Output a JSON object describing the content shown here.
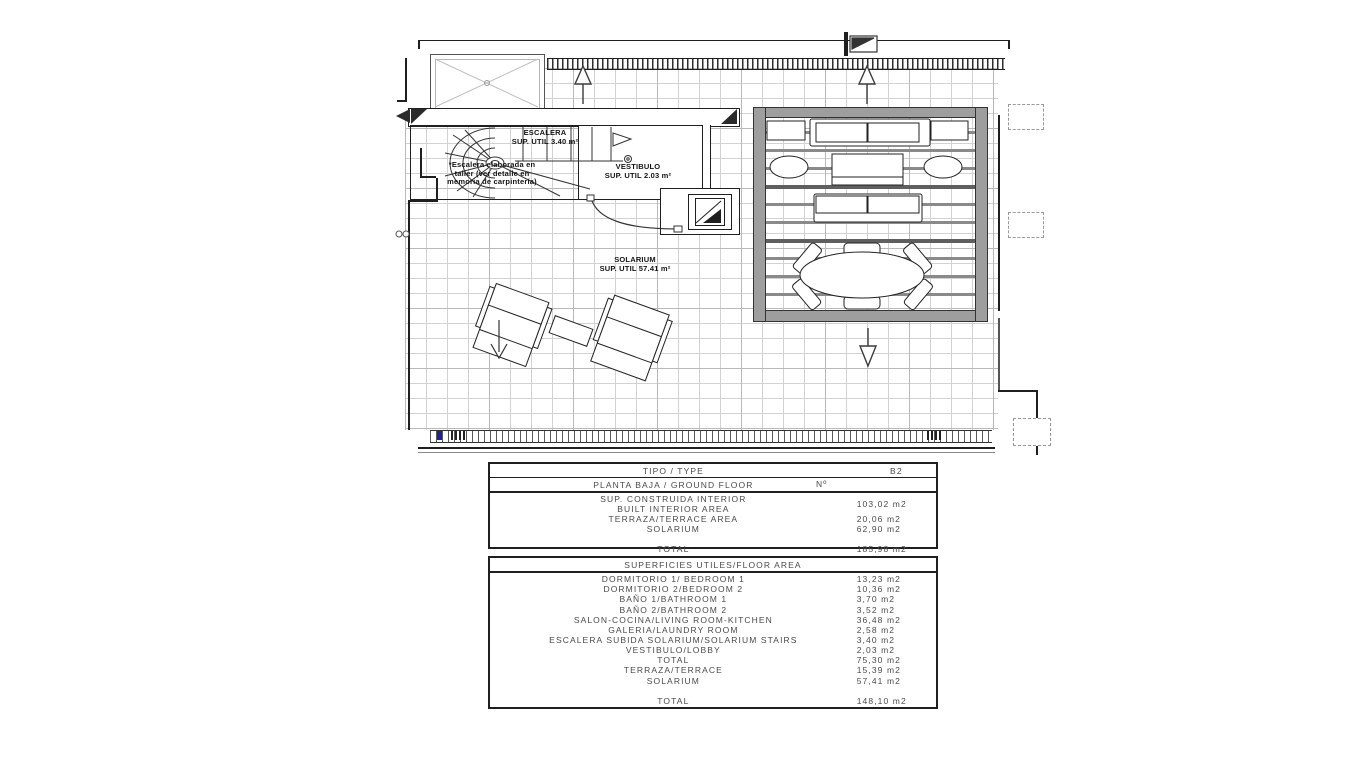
{
  "plan": {
    "escalera": {
      "title": "ESCALERA",
      "area": "SUP. UTIL 3.40 m²"
    },
    "escalera_note": {
      "line1": "*Escalera elaborada en",
      "line2": "taller (ver detalle en",
      "line3": "memoria de carpintería)"
    },
    "vestibulo": {
      "title": "VESTIBULO",
      "area": "SUP. UTIL 2.03 m²"
    },
    "solarium": {
      "title": "SOLARIUM",
      "area": "SUP. UTIL 57.41 m²"
    }
  },
  "type_table": {
    "header": {
      "label": "TIPO / TYPE",
      "value": "B2"
    },
    "subheader": {
      "label": "PLANTA BAJA / GROUND FLOOR",
      "number_label": "Nº"
    },
    "rows": [
      {
        "label": "SUP. CONSTRUIDA INTERIOR",
        "label2": "BUILT INTERIOR AREA",
        "value": "103,02 m2"
      },
      {
        "label": "TERRAZA/TERRACE AREA",
        "value": "20,06 m2"
      },
      {
        "label": "SOLARIUM",
        "value": "62,90 m2"
      },
      {
        "label": "",
        "value": ""
      },
      {
        "label": "TOTAL",
        "value": "185,98 m2"
      }
    ]
  },
  "floor_area_table": {
    "header": "SUPERFICIES UTILES/FLOOR AREA",
    "rows": [
      {
        "label": "DORMITORIO 1/ BEDROOM 1",
        "value": "13,23 m2"
      },
      {
        "label": "DORMITORIO 2/BEDROOM 2",
        "value": "10,36 m2"
      },
      {
        "label": "BAÑO 1/BATHROOM 1",
        "value": "3,70 m2"
      },
      {
        "label": "BAÑO 2/BATHROOM 2",
        "value": "3,52 m2"
      },
      {
        "label": "SALON-COCINA/LIVING ROOM-KITCHEN",
        "value": "36,48 m2"
      },
      {
        "label": "GALERIA/LAUNDRY ROOM",
        "value": "2,58 m2"
      },
      {
        "label": "ESCALERA SUBIDA SOLARIUM/SOLARIUM STAIRS",
        "value": "3,40 m2"
      },
      {
        "label": "VESTIBULO/LOBBY",
        "value": "2,03 m2"
      },
      {
        "label": "TOTAL",
        "value": "75,30 m2"
      },
      {
        "label": "TERRAZA/TERRACE",
        "value": "15,39 m2"
      },
      {
        "label": "SOLARIUM",
        "value": "57,41 m2"
      },
      {
        "label": "",
        "value": ""
      },
      {
        "label": "TOTAL",
        "value": "148,10 m2"
      }
    ]
  }
}
